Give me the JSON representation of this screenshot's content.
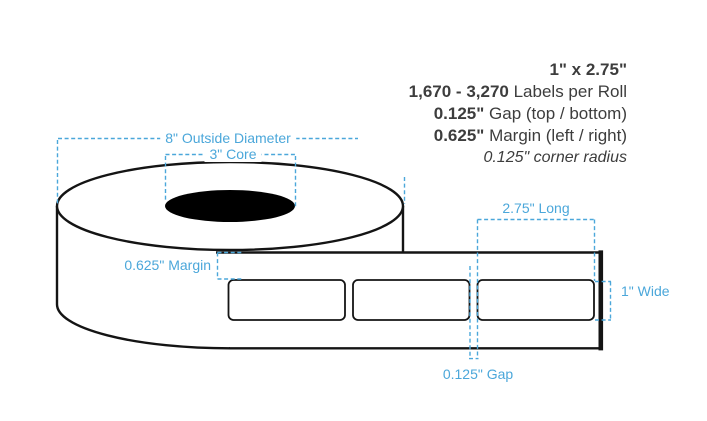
{
  "specs": {
    "size": "1\" x 2.75\"",
    "labels_per_roll_value": "1,670 - 3,270",
    "labels_per_roll_suffix": " Labels per Roll",
    "gap_value": "0.125\"",
    "gap_suffix": " Gap (top / bottom)",
    "margin_value": "0.625\"",
    "margin_suffix": " Margin (left / right)",
    "corner_radius_note": "0.125\" corner radius"
  },
  "annotations": {
    "outside_diameter": "8\" Outside Diameter",
    "core": "3\" Core",
    "margin": "0.625\" Margin",
    "label_length": "2.75\" Long",
    "label_width": "1\" Wide",
    "gap": "0.125\" Gap"
  },
  "colors": {
    "annotation_blue": "#4ba7da",
    "spec_text": "#3d3d3d",
    "diagram_line": "#141414"
  }
}
